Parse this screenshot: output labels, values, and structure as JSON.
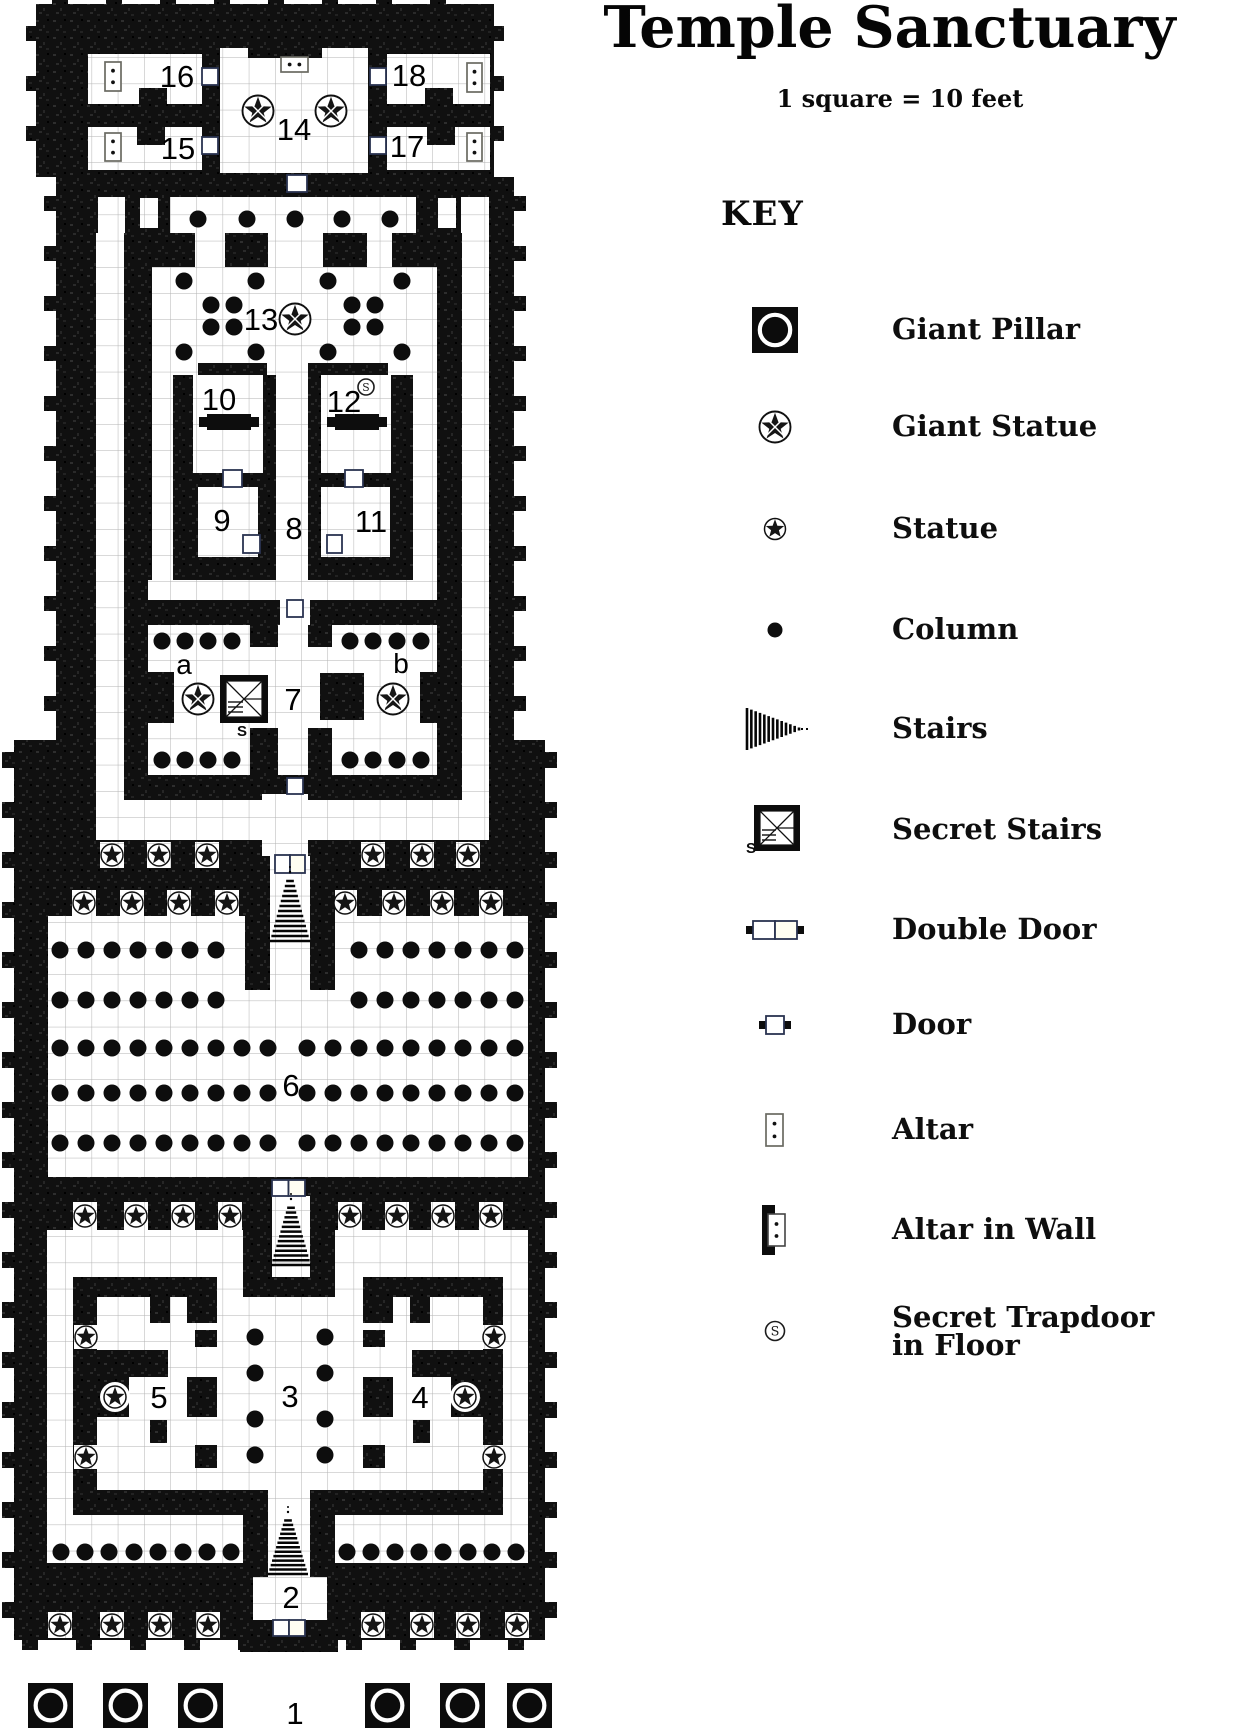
{
  "title": "Temple Sanctuary",
  "scale_note": "1 square = 10 feet",
  "key": {
    "heading": "KEY",
    "items": [
      {
        "symbol": "giant-pillar-icon",
        "label": "Giant Pillar"
      },
      {
        "symbol": "giant-statue-icon",
        "label": "Giant Statue"
      },
      {
        "symbol": "statue-icon",
        "label": "Statue"
      },
      {
        "symbol": "column-icon",
        "label": "Column"
      },
      {
        "symbol": "stairs-icon",
        "label": "Stairs"
      },
      {
        "symbol": "secret-stairs-icon",
        "label": "Secret Stairs"
      },
      {
        "symbol": "double-door-icon",
        "label": "Double Door"
      },
      {
        "symbol": "door-icon",
        "label": "Door"
      },
      {
        "symbol": "altar-icon",
        "label": "Altar"
      },
      {
        "symbol": "altar-in-wall-icon",
        "label": "Altar in Wall"
      },
      {
        "symbol": "secret-trapdoor-icon",
        "label": "Secret Trapdoor\nin Floor"
      }
    ]
  },
  "map": {
    "room_labels": [
      {
        "text": "1",
        "x": 295,
        "y": 1713
      },
      {
        "text": "2",
        "x": 291,
        "y": 1597
      },
      {
        "text": "3",
        "x": 290,
        "y": 1396
      },
      {
        "text": "4",
        "x": 420,
        "y": 1397
      },
      {
        "text": "5",
        "x": 159,
        "y": 1397
      },
      {
        "text": "6",
        "x": 291,
        "y": 1085
      },
      {
        "text": "7",
        "x": 293,
        "y": 699
      },
      {
        "text": "8",
        "x": 294,
        "y": 528
      },
      {
        "text": "9",
        "x": 222,
        "y": 520
      },
      {
        "text": "10",
        "x": 219,
        "y": 399
      },
      {
        "text": "11",
        "x": 371,
        "y": 521
      },
      {
        "text": "12",
        "x": 344,
        "y": 401
      },
      {
        "text": "13",
        "x": 261,
        "y": 319
      },
      {
        "text": "14",
        "x": 294,
        "y": 129
      },
      {
        "text": "15",
        "x": 178,
        "y": 148
      },
      {
        "text": "16",
        "x": 177,
        "y": 76
      },
      {
        "text": "17",
        "x": 407,
        "y": 146
      },
      {
        "text": "18",
        "x": 409,
        "y": 75
      },
      {
        "text": "a",
        "x": 184,
        "y": 663
      },
      {
        "text": "b",
        "x": 401,
        "y": 662
      }
    ],
    "columns": [
      {
        "y": 219,
        "xs": [
          198,
          247,
          295,
          342,
          390
        ]
      },
      {
        "y": 281,
        "xs": [
          184,
          256,
          328,
          402
        ]
      },
      {
        "y": 305,
        "xs": [
          211,
          234,
          352,
          375
        ]
      },
      {
        "y": 327,
        "xs": [
          211,
          234,
          352,
          375
        ]
      },
      {
        "y": 352,
        "xs": [
          184,
          256,
          328,
          402
        ]
      },
      {
        "y": 641,
        "xs": [
          162,
          185,
          208,
          232,
          350,
          373,
          397,
          421
        ]
      },
      {
        "y": 760,
        "xs": [
          162,
          185,
          208,
          232,
          350,
          373,
          397,
          421
        ]
      },
      {
        "y": 950,
        "xs": [
          60,
          86,
          112,
          138,
          164,
          190,
          216,
          359,
          385,
          411,
          437,
          463,
          489,
          515
        ]
      },
      {
        "y": 1000,
        "xs": [
          60,
          86,
          112,
          138,
          164,
          190,
          216,
          359,
          385,
          411,
          437,
          463,
          489,
          515
        ]
      },
      {
        "y": 1048,
        "xs": [
          60,
          86,
          112,
          138,
          164,
          190,
          216,
          242,
          268,
          307,
          333,
          359,
          385,
          411,
          437,
          463,
          489,
          515
        ]
      },
      {
        "y": 1093,
        "xs": [
          60,
          86,
          112,
          138,
          164,
          190,
          216,
          242,
          268,
          307,
          333,
          359,
          385,
          411,
          437,
          463,
          489,
          515
        ]
      },
      {
        "y": 1143,
        "xs": [
          60,
          86,
          112,
          138,
          164,
          190,
          216,
          242,
          268,
          307,
          333,
          359,
          385,
          411,
          437,
          463,
          489,
          515
        ]
      },
      {
        "y": 1337,
        "xs": [
          255,
          325
        ]
      },
      {
        "y": 1373,
        "xs": [
          255,
          325
        ]
      },
      {
        "y": 1419,
        "xs": [
          255,
          325
        ]
      },
      {
        "y": 1455,
        "xs": [
          255,
          325
        ]
      },
      {
        "y": 1552,
        "xs": [
          61,
          85,
          109,
          134,
          158,
          183,
          207,
          231,
          347,
          371,
          395,
          419,
          443,
          468,
          492,
          516
        ]
      }
    ],
    "statues": {
      "rows": [
        {
          "y": 855,
          "xs": [
            112,
            159,
            207,
            373,
            422,
            468
          ]
        },
        {
          "y": 903,
          "xs": [
            84,
            132,
            179,
            227,
            345,
            394,
            442,
            491
          ]
        },
        {
          "y": 1216,
          "xs": [
            85,
            136,
            183,
            230,
            350,
            397,
            443,
            491
          ]
        },
        {
          "y": 1625,
          "xs": [
            60,
            112,
            160,
            208,
            373,
            422,
            468,
            517
          ]
        }
      ],
      "singles": [
        [
          86,
          1337
        ],
        [
          494,
          1337
        ],
        [
          115,
          1397
        ],
        [
          465,
          1397
        ],
        [
          86,
          1457
        ],
        [
          494,
          1457
        ]
      ]
    },
    "giant_statues": [
      [
        258,
        111
      ],
      [
        331,
        111
      ],
      [
        295,
        319
      ],
      [
        198,
        699
      ],
      [
        393,
        699
      ]
    ],
    "giant_pillars": {
      "y": 1683,
      "size": 45,
      "xs": [
        28,
        103,
        178,
        365,
        440,
        507
      ]
    },
    "doors": [
      [
        202,
        68,
        16,
        17
      ],
      [
        370,
        68,
        16,
        17
      ],
      [
        202,
        137,
        16,
        17
      ],
      [
        370,
        137,
        16,
        17
      ],
      [
        287,
        175,
        20,
        17
      ],
      [
        223,
        470,
        19,
        17
      ],
      [
        345,
        470,
        18,
        17
      ],
      [
        243,
        535,
        17,
        18
      ],
      [
        327,
        535,
        15,
        18
      ],
      [
        287,
        600,
        16,
        17
      ],
      [
        287,
        778,
        16,
        16
      ]
    ],
    "double_doors": [
      [
        275,
        855,
        30,
        18
      ],
      [
        272,
        1180,
        33,
        16
      ],
      [
        273,
        1620,
        32,
        16
      ]
    ],
    "altars": {
      "vertical": [
        [
          105,
          62,
          16,
          29
        ],
        [
          105,
          133,
          16,
          28
        ],
        [
          467,
          63,
          15,
          29
        ],
        [
          467,
          133,
          15,
          28
        ]
      ],
      "horizontal": [
        [
          281,
          57,
          27,
          15
        ]
      ]
    },
    "wall_altars": [
      [
        207,
        414,
        44,
        16
      ],
      [
        335,
        414,
        44,
        16
      ]
    ],
    "secret_stairs": [
      {
        "x": 220,
        "y": 675,
        "size": 48,
        "s_label": "S"
      }
    ],
    "secret_trapdoors": [
      {
        "x": 366,
        "y": 387,
        "label": "S"
      }
    ],
    "stairs_up": [
      {
        "cx": 290,
        "y_top": 876,
        "y_bottom": 941
      },
      {
        "cx": 291,
        "y_top": 1203,
        "y_bottom": 1265
      },
      {
        "cx": 288,
        "y_top": 1516,
        "y_bottom": 1574
      }
    ]
  }
}
